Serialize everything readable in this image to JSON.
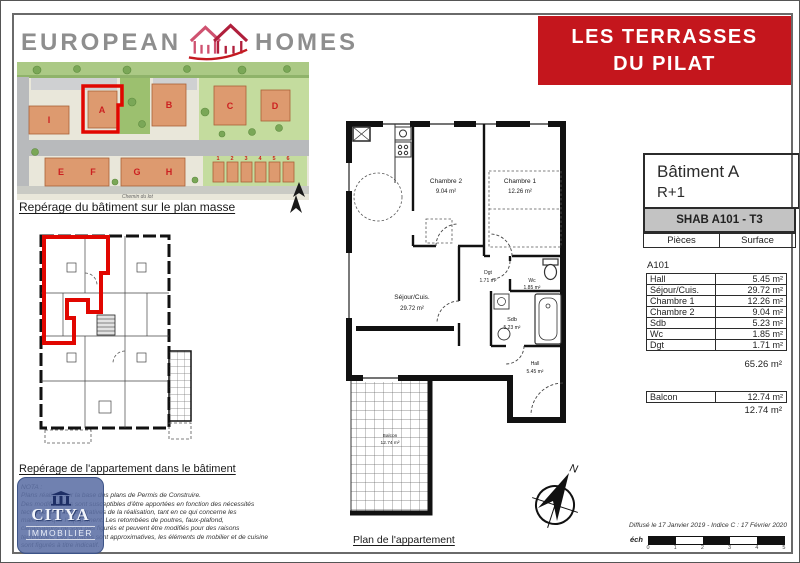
{
  "header": {
    "logo_word1": "EUROPEAN",
    "logo_word2": "HOMES",
    "banner_line1": "LES TERRASSES",
    "banner_line2": "DU PILAT"
  },
  "colors": {
    "banner_red": "#c4161d",
    "logo_gray": "#8e8e8e",
    "highlight_red": "#e10600",
    "building_orange": "#dd9a6f",
    "table_band_gray": "#c3c3c3",
    "citya_blue": "#5c70a5"
  },
  "site_plan": {
    "caption": "Repérage du bâtiment sur le plan masse",
    "street_label": "Chemin du lot",
    "building_labels": [
      "I",
      "A",
      "B",
      "C",
      "D",
      "E",
      "F",
      "G",
      "H"
    ],
    "lot_labels": [
      "1",
      "2",
      "3",
      "4",
      "5",
      "6"
    ],
    "highlighted_building": "A"
  },
  "building_plan": {
    "caption": "Repérage de l'appartement dans le bâtiment"
  },
  "apartment_plan": {
    "caption": "Plan de l'appartement",
    "compass": "N",
    "rooms": {
      "chambre2": {
        "name": "Chambre 2",
        "area": "9.04 m²"
      },
      "chambre1": {
        "name": "Chambre 1",
        "area": "12.26 m²"
      },
      "sejour": {
        "name": "Séjour/Cuis.",
        "area": "29.72 m²"
      },
      "dgt": {
        "name": "Dgt",
        "area": "1.71 m²"
      },
      "wc": {
        "name": "Wc",
        "area": "1.85 m²"
      },
      "sdb": {
        "name": "Sdb",
        "area": "5.23 m²"
      },
      "hall": {
        "name": "Hall",
        "area": "5.45 m²"
      },
      "balcon": {
        "name": "Balcon",
        "area": "12.74 m²"
      }
    }
  },
  "info_table": {
    "building_title": "Bâtiment A",
    "floor": "R+1",
    "unit_band": "SHAB A101 - T3",
    "col_pieces": "Pièces",
    "col_surface": "Surface",
    "unit_label": "A101",
    "rows": [
      {
        "piece": "Hall",
        "surface": "5.45 m²"
      },
      {
        "piece": "Séjour/Cuis.",
        "surface": "29.72 m²"
      },
      {
        "piece": "Chambre 1",
        "surface": "12.26 m²"
      },
      {
        "piece": "Chambre 2",
        "surface": "9.04 m²"
      },
      {
        "piece": "Sdb",
        "surface": "5.23 m²"
      },
      {
        "piece": "Wc",
        "surface": "1.85 m²"
      },
      {
        "piece": "Dgt",
        "surface": "1.71 m²"
      }
    ],
    "total_surface": "65.26 m²",
    "balcony_row": {
      "piece": "Balcon",
      "surface": "12.74 m²"
    },
    "balcony_total": "12.74 m²"
  },
  "footer": {
    "citya_line1": "CITYA",
    "citya_line2": "IMMOBILIER",
    "nota_lines": [
      "NOTA :",
      "Plans réalisés sur la base des plans de Permis de Construire.",
      "Des modifications sont susceptibles d'être apportées en fonction des nécessités",
      "techniques et administratives de la réalisation, tant en ce qui concerne les",
      "matériaux que l'équipement. Les retombées de poutres, faux-plafond,",
      "canalisations ne sont pas figurés et peuvent être modifiés pour des raisons",
      "techniques. Les surfaces sont approximatives, les éléments de mobilier et de cuisine",
      "sont figurés à titre indicatif."
    ],
    "diffusion_note": "Diffusé le 17 Janvier 2019 - Indice C : 17 Février 2020",
    "scale_label": "éch",
    "scale_ticks": [
      "0",
      "1",
      "2",
      "3",
      "4",
      "5"
    ]
  }
}
